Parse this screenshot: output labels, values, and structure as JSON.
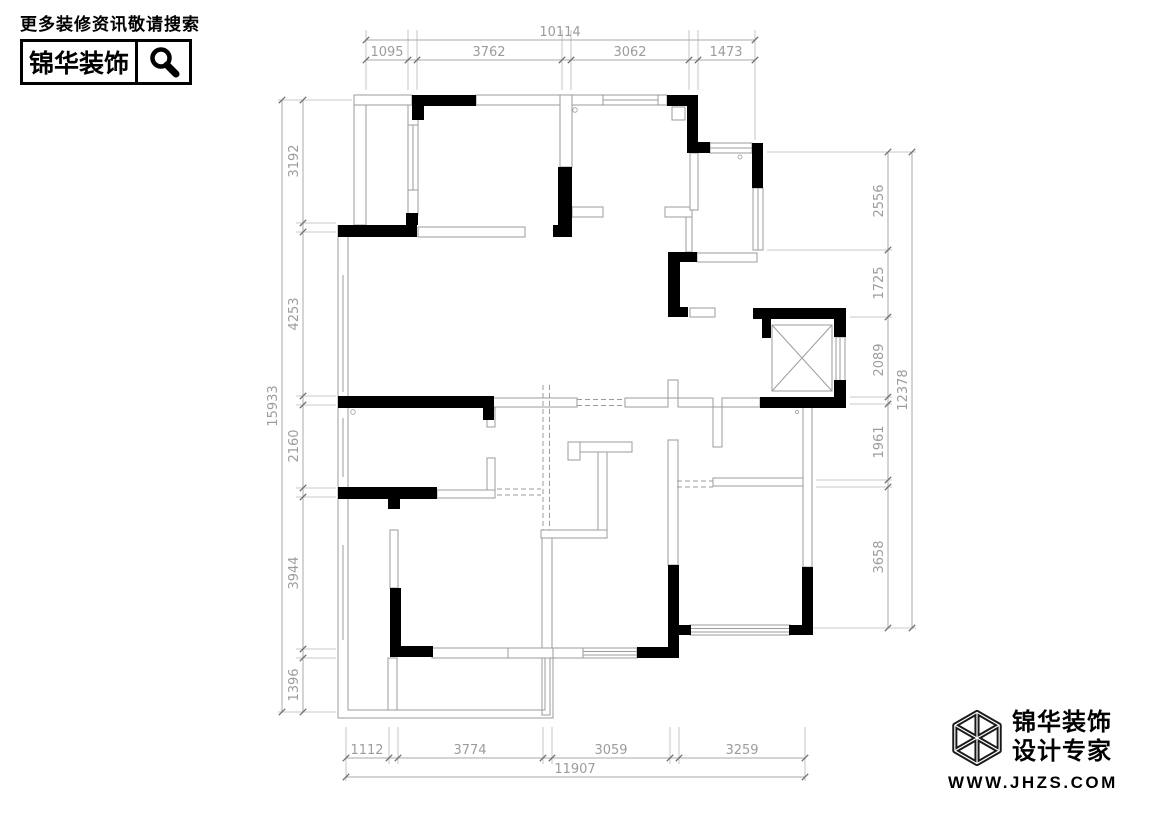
{
  "header": {
    "tagline": "更多装修资讯敬请搜索",
    "brand": "锦华装饰",
    "search_icon": "magnifier-icon"
  },
  "plan": {
    "dims": {
      "top": {
        "total": "10114",
        "segments": [
          "1095",
          "3762",
          "3062",
          "1473"
        ]
      },
      "left": {
        "total": "15933",
        "segments": [
          "3192",
          "4253",
          "2160",
          "3944",
          "1396"
        ]
      },
      "right": {
        "total": "12378",
        "segments": [
          "2556",
          "1725",
          "2089",
          "1961",
          "3658"
        ]
      },
      "bottom": {
        "total": "11907",
        "segments": [
          "1112",
          "3774",
          "3059",
          "3259"
        ]
      }
    },
    "symbols": [
      "elevator-shaft-x",
      "load-bearing-wall-fill",
      "window-double-line",
      "dashed-opening"
    ]
  },
  "footer": {
    "brand": "锦华装饰",
    "subtitle": "设计专家",
    "website": "WWW.JHZS.COM",
    "logo": "cube-wireframe-icon"
  }
}
